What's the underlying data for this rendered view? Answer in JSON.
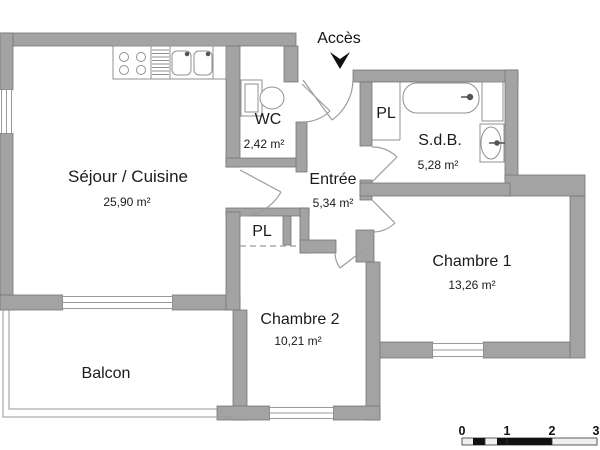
{
  "plan": {
    "access_label": "Accès",
    "rooms": [
      {
        "id": "sejour",
        "name": "Séjour / Cuisine",
        "area": "25,90 m²"
      },
      {
        "id": "wc",
        "name": "WC",
        "area": "2,42 m²"
      },
      {
        "id": "entree",
        "name": "Entrée",
        "area": "5,34 m²"
      },
      {
        "id": "sdb",
        "name": "S.d.B.",
        "area": "5,28 m²"
      },
      {
        "id": "chambre1",
        "name": "Chambre 1",
        "area": "13,26 m²"
      },
      {
        "id": "chambre2",
        "name": "Chambre 2",
        "area": "10,21 m²"
      },
      {
        "id": "balcon",
        "name": "Balcon",
        "area": ""
      }
    ],
    "closets": [
      {
        "label": "PL"
      },
      {
        "label": "PL"
      }
    ],
    "scale_bar": {
      "ticks": [
        "0",
        "1",
        "2",
        "3"
      ]
    },
    "colors": {
      "wall": "#a3a3a3",
      "wall_edge": "#757575",
      "fixture_line": "#929292",
      "text": "#1b1b1b"
    }
  }
}
